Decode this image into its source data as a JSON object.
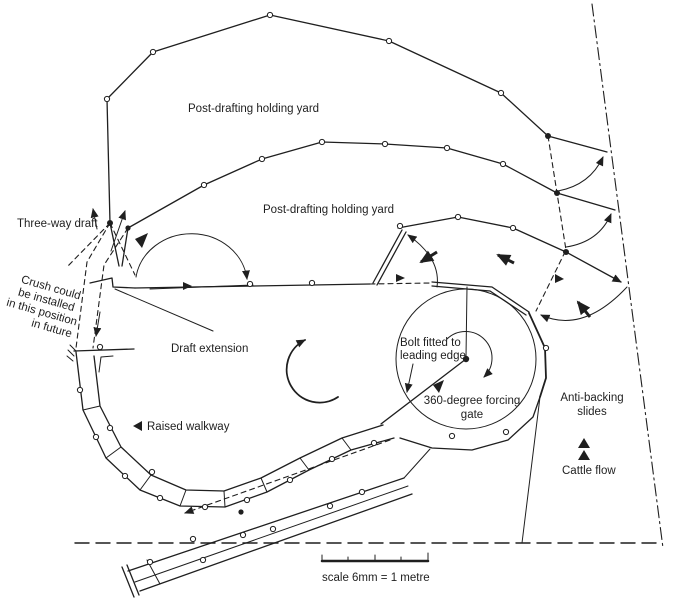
{
  "diagram": {
    "yard_labels": {
      "top": "Post-drafting holding yard",
      "middle": "Post-drafting holding yard"
    },
    "draft": {
      "three_way_label": "Three-way draft",
      "extension_label": "Draft extension",
      "crush_note": [
        "Crush could",
        "be installed",
        "in this position",
        "in future"
      ]
    },
    "walkway_label": "Raised walkway",
    "forcing_gate": {
      "bolt_note": [
        "Bolt fitted to",
        "leading edge"
      ],
      "gate_label": [
        "360-degree forcing",
        "gate"
      ]
    },
    "flow": {
      "anti_backing_label": [
        "Anti-backing",
        "slides"
      ],
      "cattle_flow_label": "Cattle flow"
    },
    "scale_label": "scale 6mm = 1 metre",
    "colors": {
      "ink": "#1f1f1f",
      "paper": "#ffffff"
    }
  }
}
